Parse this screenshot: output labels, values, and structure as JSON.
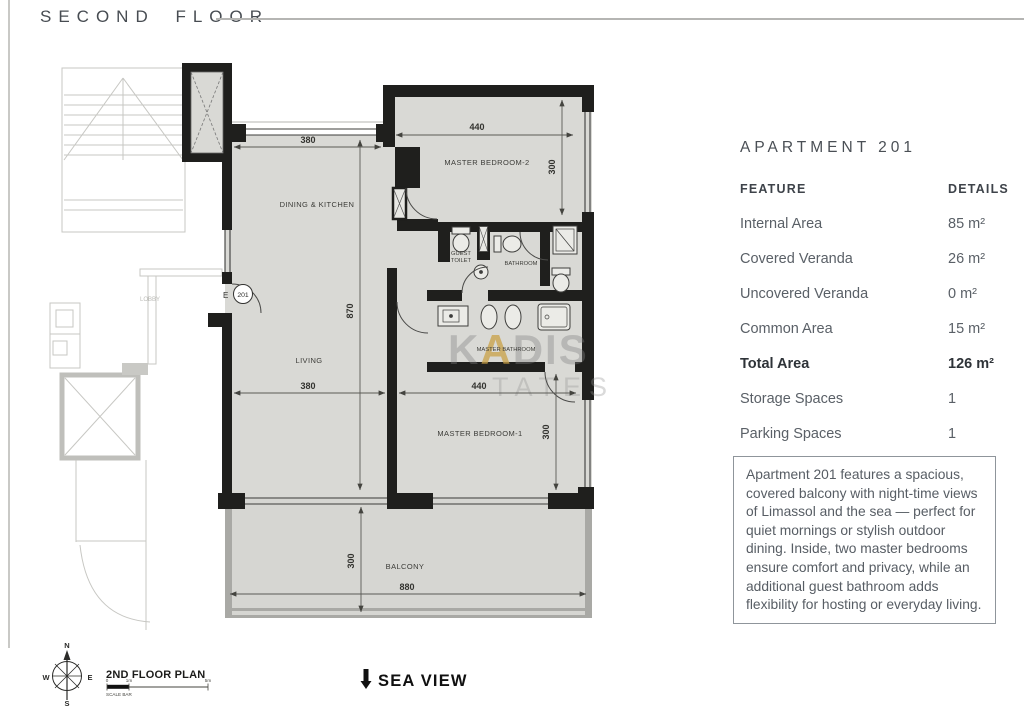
{
  "header": {
    "title": "SECOND FLOOR"
  },
  "panel": {
    "title": "APARTMENT 201",
    "columns": {
      "feature": "FEATURE",
      "details": "DETAILS"
    },
    "rows": [
      {
        "feature": "Internal Area",
        "details": "85 m²"
      },
      {
        "feature": "Covered Veranda",
        "details": "26 m²"
      },
      {
        "feature": "Uncovered Veranda",
        "details": "0 m²"
      },
      {
        "feature": "Common Area",
        "details": "15 m²"
      },
      {
        "feature": "Total Area",
        "details": "126 m²"
      },
      {
        "feature": "Storage Spaces",
        "details": "1"
      },
      {
        "feature": "Parking Spaces",
        "details": "1"
      }
    ],
    "description": "Apartment 201 features a spacious, covered balcony with night-time views of Limassol and the sea — perfect for quiet mornings or stylish outdoor dining. Inside, two master bedrooms ensure comfort and privacy, while an additional guest bathroom adds flexibility for hosting or everyday living."
  },
  "plan": {
    "labels": {
      "dining": "DINING & KITCHEN",
      "mb2": "MASTER BEDROOM-2",
      "mb1": "MASTER BEDROOM-1",
      "living": "LIVING",
      "balcony": "BALCONY",
      "guest1": "GUEST",
      "guest2": "TOILET",
      "bathroom": "BATHROOM",
      "master_bath": "MASTER BATHROOM",
      "lobby": "LOBBY"
    },
    "entry": {
      "label": "E",
      "number": "201"
    },
    "dims": {
      "dining_width": "380",
      "mb2_width": "440",
      "mb2_depth": "300",
      "height": "870",
      "living_width": "380",
      "mb1_width": "440",
      "mb1_depth": "300",
      "balcony_depth": "300",
      "balcony_width": "880"
    },
    "watermark": {
      "k": "K",
      "a": "A",
      "dis": "DIS",
      "line2": "TATES"
    }
  },
  "footer": {
    "plan_name": "2ND FLOOR PLAN",
    "scale": {
      "label": "SCALE BAR",
      "t0": "0",
      "t1": "1m",
      "t5": "5m"
    },
    "compass": {
      "n": "N",
      "e": "E",
      "s": "S",
      "w": "W"
    },
    "sea_view": "SEA VIEW"
  },
  "colors": {
    "wall": "#1f1f1d",
    "floor": "#d9d9d5",
    "watermark_gold": "#c8a24e"
  }
}
